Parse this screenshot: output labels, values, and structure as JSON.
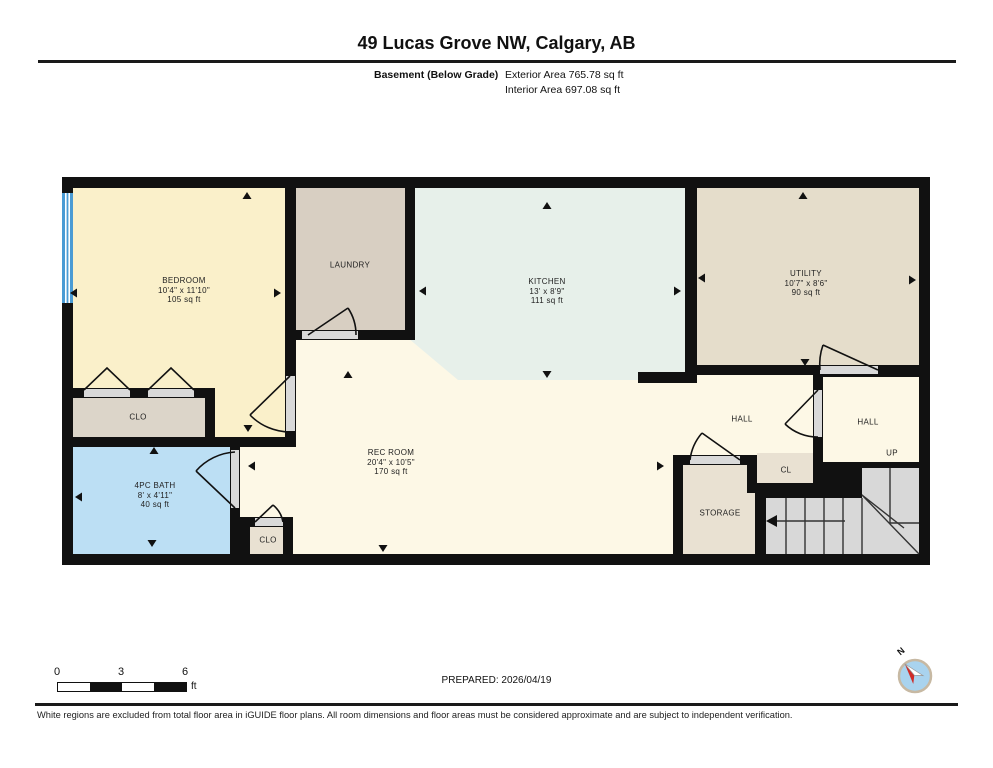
{
  "header": {
    "title": "49 Lucas Grove NW, Calgary, AB",
    "floor_label": "Basement (Below Grade)",
    "exterior_area": "Exterior Area 765.78 sq ft",
    "interior_area": "Interior Area 697.08 sq ft"
  },
  "rooms": {
    "bedroom": {
      "name": "BEDROOM",
      "dims": "10'4\" x 11'10\"",
      "area": "105 sq ft"
    },
    "laundry": {
      "name": "LAUNDRY"
    },
    "kitchen": {
      "name": "KITCHEN",
      "dims": "13' x 8'9\"",
      "area": "111 sq ft"
    },
    "utility": {
      "name": "UTILITY",
      "dims": "10'7\" x 8'6\"",
      "area": "90 sq ft"
    },
    "rec_room": {
      "name": "REC ROOM",
      "dims": "20'4\" x 10'5\"",
      "area": "170 sq ft"
    },
    "bath": {
      "name": "4PC BATH",
      "dims": "8' x 4'11\"",
      "area": "40 sq ft"
    },
    "closet_bedroom": {
      "name": "CLO"
    },
    "closet_rec": {
      "name": "CLO"
    },
    "cl": {
      "name": "CL"
    },
    "hall_left": {
      "name": "HALL"
    },
    "hall_right": {
      "name": "HALL"
    },
    "storage": {
      "name": "STORAGE"
    },
    "up": {
      "name": "UP"
    }
  },
  "footer": {
    "scale_ticks": {
      "t0": "0",
      "t1": "3",
      "t2": "6"
    },
    "scale_unit": "ft",
    "prepared": "PREPARED: 2026/04/19",
    "compass_n": "N",
    "disclaimer": "White regions are excluded from total floor area in iGUIDE floor plans. All room dimensions and floor areas must be considered approximate and are subject to independent verification."
  },
  "colors": {
    "wall": "#111111",
    "bedroom": "#faf0ca",
    "laundry": "#d8cfc2",
    "kitchen": "#e7f0ea",
    "utility": "#e5ddcb",
    "closet": "#dcd5c9",
    "bath": "#bcdff4",
    "cream": "#fdf8e6",
    "beige": "#e9e1d2",
    "stairs": "#d8d8d8",
    "window": "#4a9bd4",
    "door_sill": "#d9d9d9",
    "compass_blue": "#a9d3ee",
    "compass_red": "#cf2b27"
  }
}
